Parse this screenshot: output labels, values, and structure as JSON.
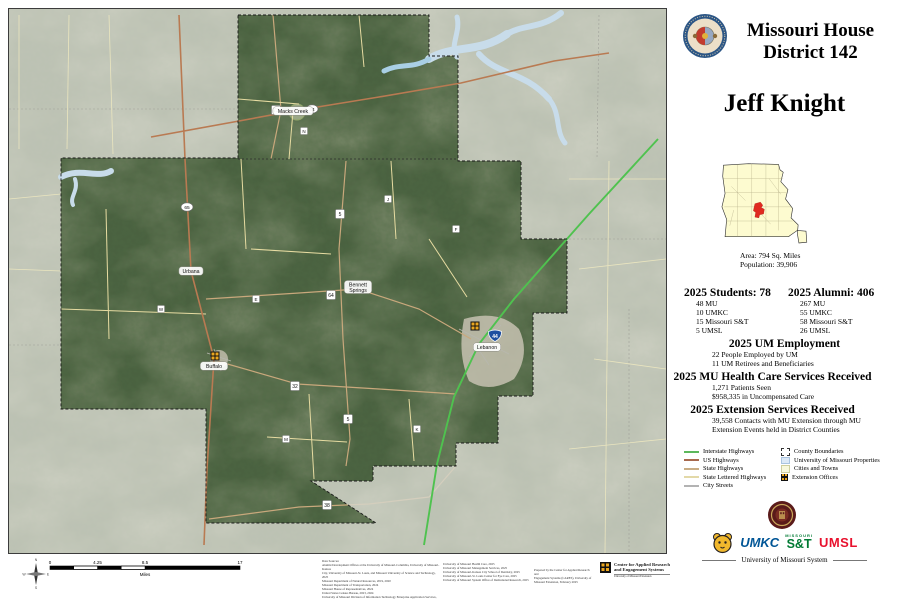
{
  "header": {
    "title_line1": "Missouri House",
    "title_line2": "District 142"
  },
  "representative": "Jeff Knight",
  "inset": {
    "area_label": "Area: 794 Sq. Miles",
    "population_label": "Population: 39,906"
  },
  "stats": {
    "students": {
      "heading": "2025 Students: 78",
      "items": [
        "48 MU",
        "10 UMKC",
        "15 Missouri S&T",
        "5 UMSL"
      ]
    },
    "alumni": {
      "heading": "2025 Alumni: 406",
      "items": [
        "267 MU",
        "55 UMKC",
        "58 Missouri S&T",
        "26 UMSL"
      ]
    },
    "employment": {
      "heading": "2025 UM Employment",
      "items": [
        "22 People Employed by UM",
        "11 UM Retirees and Beneficiaries"
      ]
    },
    "healthcare": {
      "heading": "2025 MU Health Care Services Received",
      "items": [
        "1,271 Patients Seen",
        "$958,335 in Uncompensated Care"
      ]
    },
    "extension": {
      "heading": "2025 Extension Services Received",
      "items": [
        "39,558 Contacts with MU Extension through MU",
        "Extension Events held in District Counties"
      ]
    }
  },
  "legend": {
    "line_items": [
      {
        "label": "Interstate Highways",
        "color": "#5cb85c"
      },
      {
        "label": "US Highways",
        "color": "#a8694e"
      },
      {
        "label": "State Highways",
        "color": "#c9ad85"
      },
      {
        "label": "State Lettered Highways",
        "color": "#e3d9a8"
      },
      {
        "label": "City Streets",
        "color": "#b3b3b3"
      }
    ],
    "area_items": [
      {
        "label": "County Boundaries"
      },
      {
        "label": "University of Missouri Properties",
        "color": "#dce9f7"
      },
      {
        "label": "Cities and Towns",
        "color": "#f8f8dc"
      },
      {
        "label": "Extension Offices",
        "color": "#eaa61f"
      }
    ]
  },
  "logos": {
    "umkc": "UMKC",
    "st_top": "MISSOURI",
    "st": "S&T",
    "umsl": "UMSL",
    "system_label": "University of Missouri System"
  },
  "cares": {
    "line1": "Center for Applied Research",
    "line2": "and Engagement Systems",
    "line3": "University of Missouri Extension"
  },
  "credits": {
    "col1": [
      "Data Sources:",
      "Alumni Development Offices at the University of Missouri-Columbia, University of Missouri-Kansas",
      "City, University of Missouri-St. Louis, and Missouri University of Science and Technology, 2025",
      "Missouri Department of Natural Resources, 2019, 2020",
      "Missouri Department of Transportation, 2024",
      "Missouri House of Representatives, 2024",
      "United States Census Bureau, 2023, 2024",
      "University of Missouri Division of Information Technology Enterprise Application Services, 2025",
      "University of Missouri Extension, 2025"
    ],
    "col2": [
      "University of Missouri Health Care, 2025",
      "University of Missouri Management Services, 2025",
      "University of Missouri-Kansas City School of Dentistry, 2025",
      "University of Missouri-St. Louis Center for Eye Care, 2025",
      "University of Missouri System Office of Institutional Research, 2025"
    ],
    "col3": [
      "Prepared by the Center for Applied Research and",
      "Engagement Systems (CARES), University of",
      "Missouri Extension, February 2025"
    ]
  },
  "compass": {
    "n": "N",
    "s": "S",
    "e": "E",
    "w": "W"
  },
  "map": {
    "scale": {
      "ticks": [
        "0",
        "4.25",
        "8.5",
        "17"
      ],
      "unit": "Miles"
    },
    "cities": [
      {
        "lines": [
          "Macks Creek"
        ],
        "x": 284,
        "y": 102
      },
      {
        "lines": [
          "Urbana"
        ],
        "x": 182,
        "y": 262
      },
      {
        "lines": [
          "Bennett",
          "Springs"
        ],
        "x": 349,
        "y": 278
      },
      {
        "lines": [
          "Buffalo"
        ],
        "x": 205,
        "y": 357
      },
      {
        "lines": [
          "Lebanon"
        ],
        "x": 478,
        "y": 338
      }
    ],
    "shields": [
      {
        "type": "interstate",
        "text": "44",
        "x": 486,
        "y": 327
      },
      {
        "type": "us",
        "text": "54",
        "x": 303,
        "y": 100
      },
      {
        "type": "us",
        "text": "65",
        "x": 178,
        "y": 198
      },
      {
        "type": "state",
        "text": "73",
        "x": 267,
        "y": 101
      },
      {
        "type": "state",
        "text": "5",
        "x": 331,
        "y": 205
      },
      {
        "type": "state",
        "text": "64",
        "x": 322,
        "y": 286
      },
      {
        "type": "state",
        "text": "32",
        "x": 286,
        "y": 377
      },
      {
        "type": "state",
        "text": "38",
        "x": 318,
        "y": 496
      },
      {
        "type": "state",
        "text": "5",
        "x": 339,
        "y": 410
      },
      {
        "type": "lettered",
        "text": "J",
        "x": 379,
        "y": 190
      },
      {
        "type": "lettered",
        "text": "E",
        "x": 247,
        "y": 290
      },
      {
        "type": "lettered",
        "text": "K",
        "x": 408,
        "y": 420
      },
      {
        "type": "lettered",
        "text": "M",
        "x": 277,
        "y": 430
      },
      {
        "type": "lettered",
        "text": "F",
        "x": 447,
        "y": 220
      },
      {
        "type": "lettered",
        "text": "N",
        "x": 295,
        "y": 122
      },
      {
        "type": "lettered",
        "text": "W",
        "x": 152,
        "y": 300
      }
    ],
    "extension_offices": [
      {
        "x": 206,
        "y": 347
      },
      {
        "x": 466,
        "y": 317
      }
    ]
  }
}
